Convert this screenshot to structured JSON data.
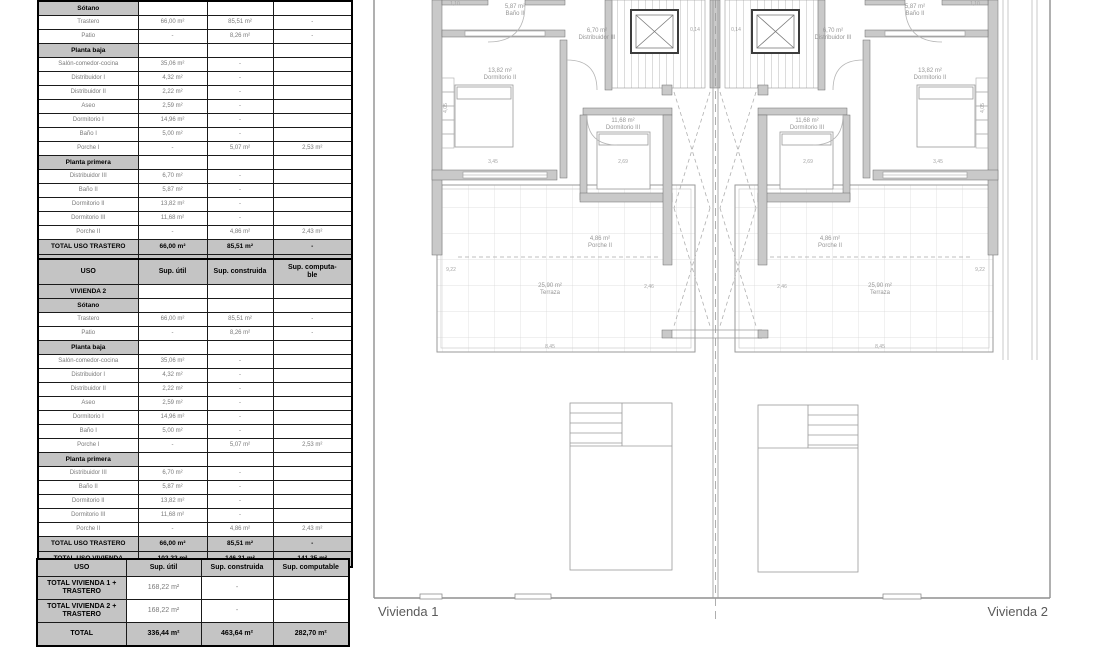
{
  "colors": {
    "wall_gray": "#c9c9c9",
    "section_bg": "#c4c4c4",
    "plan_line": "#9a9a9a"
  },
  "tables": {
    "vivienda1": {
      "rows": [
        {
          "type": "section",
          "cells": [
            "Sótano",
            "",
            "",
            ""
          ]
        },
        {
          "type": "data",
          "cells": [
            "Trastero",
            "66,00 m²",
            "85,51 m²",
            "-"
          ]
        },
        {
          "type": "data",
          "cells": [
            "Patio",
            "-",
            "8,26 m²",
            "-"
          ]
        },
        {
          "type": "section",
          "cells": [
            "Planta baja",
            "",
            "",
            ""
          ]
        },
        {
          "type": "data",
          "cells": [
            "Salón-comedor-cocina",
            "35,06 m²",
            "-",
            ""
          ]
        },
        {
          "type": "data",
          "cells": [
            "Distribuidor I",
            "4,32 m²",
            "-",
            ""
          ]
        },
        {
          "type": "data",
          "cells": [
            "Distribuidor II",
            "2,22 m²",
            "-",
            ""
          ]
        },
        {
          "type": "data",
          "cells": [
            "Aseo",
            "2,59 m²",
            "-",
            ""
          ]
        },
        {
          "type": "data",
          "cells": [
            "Dormitorio I",
            "14,96 m²",
            "-",
            ""
          ]
        },
        {
          "type": "data",
          "cells": [
            "Baño I",
            "5,00 m²",
            "-",
            ""
          ]
        },
        {
          "type": "data",
          "cells": [
            "Porche I",
            "-",
            "5,07 m²",
            "2,53 m²"
          ]
        },
        {
          "type": "section",
          "cells": [
            "Planta primera",
            "",
            "",
            ""
          ]
        },
        {
          "type": "data",
          "cells": [
            "Distribuidor III",
            "6,70 m²",
            "-",
            ""
          ]
        },
        {
          "type": "data",
          "cells": [
            "Baño II",
            "5,87 m²",
            "-",
            ""
          ]
        },
        {
          "type": "data",
          "cells": [
            "Dormitorio II",
            "13,82 m²",
            "-",
            ""
          ]
        },
        {
          "type": "data",
          "cells": [
            "Dormitorio III",
            "11,68 m²",
            "-",
            ""
          ]
        },
        {
          "type": "data",
          "cells": [
            "Porche II",
            "-",
            "4,86 m²",
            "2,43 m²"
          ]
        },
        {
          "type": "total",
          "cells": [
            "TOTAL USO TRASTERO",
            "66,00 m²",
            "85,51 m²",
            "-"
          ]
        },
        {
          "type": "total",
          "cells": [
            "TOTAL USO VIVIENDA",
            "102,22 m²",
            "146,31 m²",
            "141,35 m²"
          ]
        }
      ]
    },
    "vivienda2": {
      "header": [
        "USO",
        "Sup. útil",
        "Sup. construida",
        "Sup. computa-\nble"
      ],
      "rows": [
        {
          "type": "section",
          "cells": [
            "VIVIENDA 2",
            "",
            "",
            ""
          ]
        },
        {
          "type": "section",
          "cells": [
            "Sótano",
            "",
            "",
            ""
          ]
        },
        {
          "type": "data",
          "cells": [
            "Trastero",
            "66,00 m²",
            "85,51 m²",
            "-"
          ]
        },
        {
          "type": "data",
          "cells": [
            "Patio",
            "-",
            "8,26 m²",
            "-"
          ]
        },
        {
          "type": "section",
          "cells": [
            "Planta baja",
            "",
            "",
            ""
          ]
        },
        {
          "type": "data",
          "cells": [
            "Salón-comedor-cocina",
            "35,06 m²",
            "-",
            ""
          ]
        },
        {
          "type": "data",
          "cells": [
            "Distribuidor I",
            "4,32 m²",
            "-",
            ""
          ]
        },
        {
          "type": "data",
          "cells": [
            "Distribuidor II",
            "2,22 m²",
            "-",
            ""
          ]
        },
        {
          "type": "data",
          "cells": [
            "Aseo",
            "2,59 m²",
            "-",
            ""
          ]
        },
        {
          "type": "data",
          "cells": [
            "Dormitorio I",
            "14,96 m²",
            "-",
            ""
          ]
        },
        {
          "type": "data",
          "cells": [
            "Baño I",
            "5,00 m²",
            "-",
            ""
          ]
        },
        {
          "type": "data",
          "cells": [
            "Porche I",
            "-",
            "5,07 m²",
            "2,53 m²"
          ]
        },
        {
          "type": "section",
          "cells": [
            "Planta primera",
            "",
            "",
            ""
          ]
        },
        {
          "type": "data",
          "cells": [
            "Distribuidor III",
            "6,70 m²",
            "-",
            ""
          ]
        },
        {
          "type": "data",
          "cells": [
            "Baño II",
            "5,87 m²",
            "-",
            ""
          ]
        },
        {
          "type": "data",
          "cells": [
            "Dormitorio II",
            "13,82 m²",
            "-",
            ""
          ]
        },
        {
          "type": "data",
          "cells": [
            "Dormitorio III",
            "11,68 m²",
            "-",
            ""
          ]
        },
        {
          "type": "data",
          "cells": [
            "Porche II",
            "-",
            "4,86 m²",
            "2,43 m²"
          ]
        },
        {
          "type": "total",
          "cells": [
            "TOTAL USO TRASTERO",
            "66,00 m²",
            "85,51 m²",
            "-"
          ]
        },
        {
          "type": "total",
          "cells": [
            "TOTAL USO VIVIENDA",
            "102,22 m²",
            "146,31 m²",
            "141,35 m²"
          ]
        }
      ]
    },
    "summary": {
      "header": [
        "USO",
        "Sup. útil",
        "Sup. construida",
        "Sup. computable"
      ],
      "rows": [
        {
          "type": "rowhead",
          "cells": [
            "TOTAL VIVIENDA 1 + TRASTERO",
            "168,22 m²",
            "-",
            ""
          ]
        },
        {
          "type": "rowhead",
          "cells": [
            "TOTAL VIVIENDA 2 + TRASTERO",
            "168,22 m²",
            "-",
            ""
          ]
        },
        {
          "type": "total",
          "cells": [
            "TOTAL",
            "336,44 m²",
            "463,64 m²",
            "282,70 m²"
          ]
        }
      ]
    }
  },
  "plan": {
    "vivienda1_label": "Vivienda 1",
    "vivienda2_label": "Vivienda 2",
    "left": {
      "bano": {
        "area": "5,87 m²",
        "name": "Baño II"
      },
      "dist": {
        "area": "6,70 m²",
        "name": "Distribuidor III"
      },
      "dorm2": {
        "area": "13,82 m²",
        "name": "Dormitorio II"
      },
      "dorm3": {
        "area": "11,68 m²",
        "name": "Dormitorio III"
      },
      "porche": {
        "area": "4,86 m²",
        "name": "Porche II"
      },
      "terraza": {
        "area": "25,90 m²",
        "name": "Terraza"
      }
    },
    "right": {
      "bano": {
        "area": "5,87 m²",
        "name": "Baño II"
      },
      "dist": {
        "area": "6,70 m²",
        "name": "Distribuidor III"
      },
      "dorm2": {
        "area": "13,82 m²",
        "name": "Dormitorio II"
      },
      "dorm3": {
        "area": "11,68 m²",
        "name": "Dormitorio III"
      },
      "porche": {
        "area": "4,86 m²",
        "name": "Porche II"
      },
      "terraza": {
        "area": "25,90 m²",
        "name": "Terraza"
      }
    },
    "dims": [
      "1,10",
      "0,14",
      "0,14",
      "3,45",
      "2,69",
      "2,69",
      "3,45",
      "4,05",
      "4,05",
      "9,22",
      "2,46",
      "8,45",
      "8,45",
      "2,46",
      "9,22",
      "1,10"
    ]
  }
}
